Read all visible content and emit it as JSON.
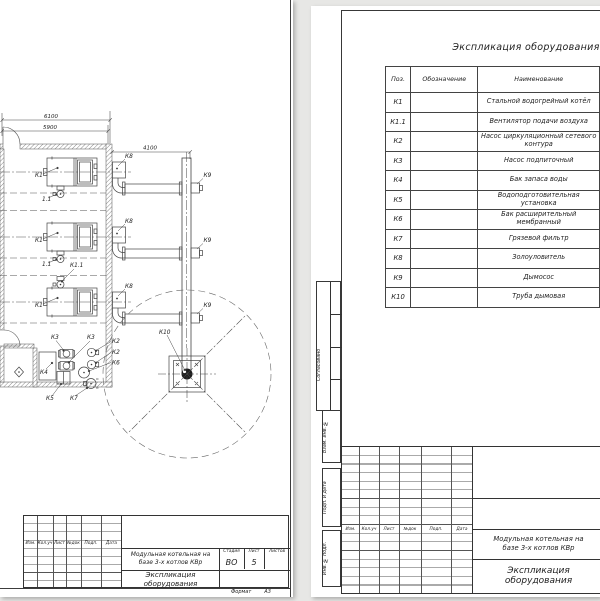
{
  "doc_title": "Экспликация оборудования",
  "project": {
    "line1": "Модульная котельная на",
    "line2": "базе 3-х котлов КВр"
  },
  "spec": {
    "title": "Экспликация оборудования",
    "headers": [
      "Поз.",
      "Обозначение",
      "Наименование"
    ],
    "rows": [
      [
        "К1",
        "",
        "Стальной водогрейный котёл"
      ],
      [
        "К1.1",
        "",
        "Вентилятор подачи воздуха"
      ],
      [
        "К2",
        "",
        "Насос циркуляционный сетевого контура"
      ],
      [
        "К3",
        "",
        "Насос подпиточный"
      ],
      [
        "К4",
        "",
        "Бак запаса воды"
      ],
      [
        "К5",
        "",
        "Водоподготовительная установка"
      ],
      [
        "К6",
        "",
        "Бак расширительный мембранный"
      ],
      [
        "К7",
        "",
        "Грязевой фильтр"
      ],
      [
        "К8",
        "",
        "Золоуловитель"
      ],
      [
        "К9",
        "",
        "Дымосос"
      ],
      [
        "К10",
        "",
        "Труба дымовая"
      ]
    ]
  },
  "rev_headers": [
    "Изм.",
    "Кол.уч",
    "Лист",
    "№док",
    "Подп.",
    "Дата"
  ],
  "left_stamp": {
    "stage_label": "Стадия",
    "sheet_label": "Лист",
    "sheets_label": "Листов",
    "stage": "ВО",
    "sheet_num": "5",
    "format_label": "Формат",
    "format_value": "А3"
  },
  "side_labels": [
    "Согласовано",
    "Взам. инв. №",
    "Подп. и дата",
    "Инв. № подл."
  ],
  "drawing": {
    "dims": [
      "6100",
      "5900",
      "4100"
    ],
    "labels": {
      "k1": "К1",
      "k1_1": "К1.1",
      "f1_1": "1.1",
      "k2": "К2",
      "k3": "К3",
      "k4": "К4",
      "k5": "К5",
      "k6": "К6",
      "k7": "К7",
      "k8": "К8",
      "k9": "К9",
      "k10": "К10"
    }
  }
}
